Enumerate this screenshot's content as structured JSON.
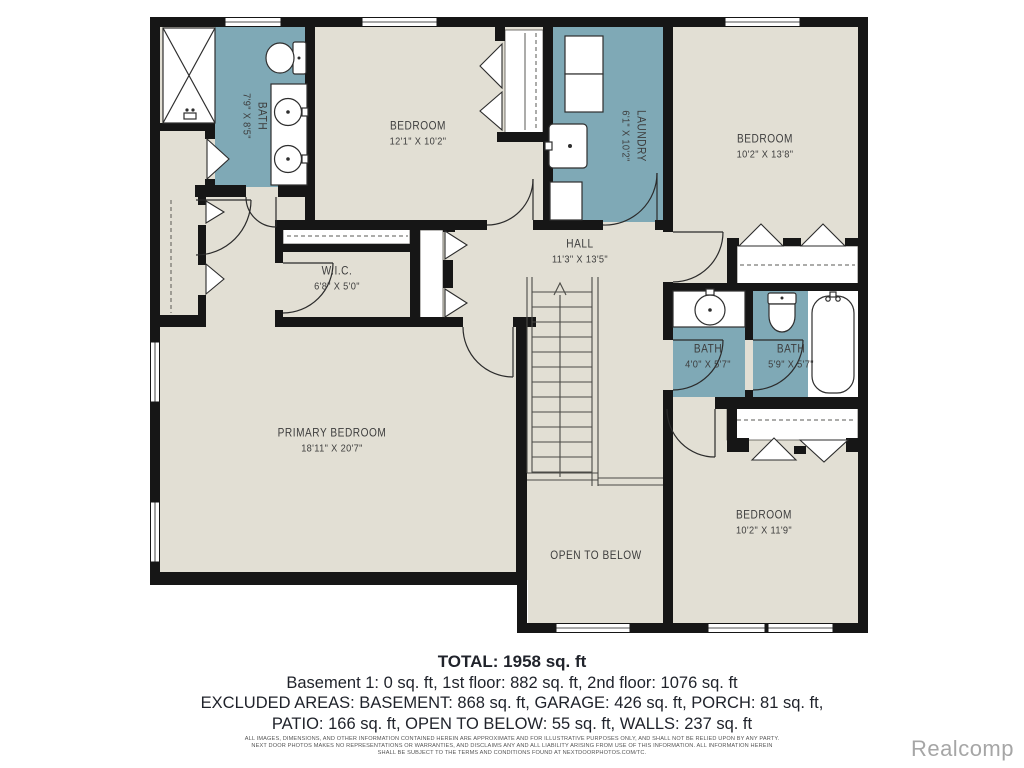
{
  "plan": {
    "rooms": [
      {
        "name": "BATH",
        "dims": "7'9\" X 8'5\""
      },
      {
        "name": "BEDROOM",
        "dims": "12'1\" X 10'2\""
      },
      {
        "name": "LAUNDRY",
        "dims": "6'1\" X 10'2\""
      },
      {
        "name": "BEDROOM",
        "dims": "10'2\" X 13'8\""
      },
      {
        "name": "HALL",
        "dims": "11'3\" X 13'5\""
      },
      {
        "name": "W.I.C.",
        "dims": "6'8\" X 5'0\""
      },
      {
        "name": "BATH",
        "dims": "4'0\" X 5'7\""
      },
      {
        "name": "BATH",
        "dims": "5'9\" X 5'7\""
      },
      {
        "name": "PRIMARY BEDROOM",
        "dims": "18'11\" X 20'7\""
      },
      {
        "name": "OPEN TO BELOW",
        "dims": ""
      },
      {
        "name": "BEDROOM",
        "dims": "10'2\" X 11'9\""
      }
    ],
    "colors": {
      "wet_area": "#7fa9b6",
      "floor": "#e2dfd4",
      "wall": "#161616"
    }
  },
  "summary": {
    "total": "TOTAL: 1958 sq. ft",
    "lines": [
      "Basement 1: 0 sq. ft, 1st floor: 882 sq. ft, 2nd floor: 1076 sq. ft",
      "EXCLUDED AREAS: BASEMENT: 868 sq. ft, GARAGE: 426 sq. ft, PORCH: 81 sq. ft,",
      "PATIO: 166 sq. ft, OPEN TO BELOW: 55 sq. ft, WALLS: 237 sq. ft"
    ]
  },
  "disclaimer": {
    "lines": [
      "ALL IMAGES, DIMENSIONS, AND OTHER INFORMATION CONTAINED HEREIN ARE APPROXIMATE AND FOR ILLUSTRATIVE PURPOSES ONLY, AND SHALL NOT BE RELIED UPON BY ANY PARTY.",
      "NEXT DOOR PHOTOS MAKES NO REPRESENTATIONS OR WARRANTIES, AND DISCLAIMS ANY AND ALL LIABILITY ARISING FROM USE OF THIS INFORMATION. ALL INFORMATION HEREIN",
      "SHALL BE SUBJECT TO THE TERMS AND CONDITIONS FOUND AT NEXTDOORPHOTOS.COM/TC."
    ]
  },
  "watermark": "Realcomp"
}
